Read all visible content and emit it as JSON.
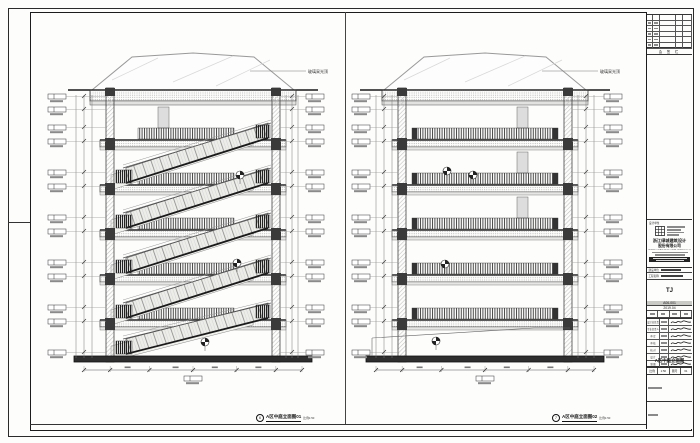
{
  "sheet": {
    "captions": {
      "left": {
        "num": "6",
        "title": "A区中庭立面图01",
        "scale": "比例1:50"
      },
      "mid": {
        "num": "7",
        "title": "A区中庭立面图02",
        "scale": "比例1:50"
      }
    },
    "labels": {
      "skylight": "玻璃采光顶"
    }
  },
  "titleblock": {
    "sign_bar": "会 签 栏",
    "unit_label": "设计单位",
    "company_cn1": "浙江绿城建筑设计",
    "company_cn2": "股份有限公司",
    "company_en": "GREENTON ARCHITECTURAL DESIGN CO.,LTD.",
    "client_label": "建设单位",
    "project_label": "工程名称",
    "stage": "TJ",
    "project_no": "A06-001",
    "date": "2019.04",
    "staff_labels": [
      "设计总负责",
      "专业负责人",
      "审 定",
      "审 核",
      "校 对",
      "设 计",
      "制 图"
    ],
    "drawing_title": "A区中庭立面图",
    "scale_label": "比例",
    "scale": "1:50",
    "sheet_label": "图号",
    "sheet_no": "61",
    "colors": {
      "line": "#1a1a1a",
      "hatch": "#4a4a4a",
      "ground": "#2e2e2e"
    }
  }
}
